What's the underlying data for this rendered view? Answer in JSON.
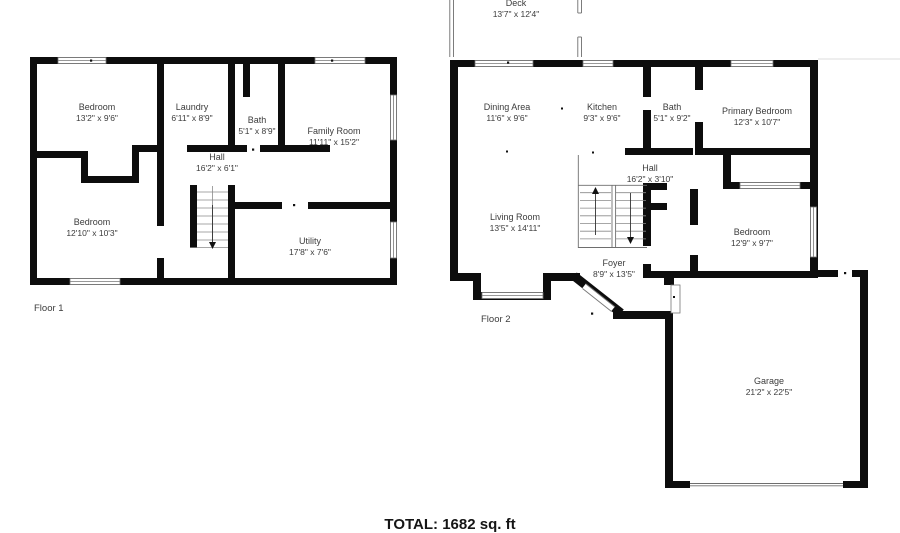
{
  "document": {
    "total": "TOTAL: 1682 sq. ft"
  },
  "floors": [
    {
      "label": "Floor 1",
      "rooms": [
        {
          "name": "Bedroom",
          "dims": "13'2\" x 9'6\""
        },
        {
          "name": "Laundry",
          "dims": "6'11\" x 8'9\""
        },
        {
          "name": "Bath",
          "dims": "5'1\" x 8'9\""
        },
        {
          "name": "Family Room",
          "dims": "11'11\" x 15'2\""
        },
        {
          "name": "Hall",
          "dims": "16'2\" x 6'1\""
        },
        {
          "name": "Bedroom",
          "dims": "12'10\" x 10'3\""
        },
        {
          "name": "Utility",
          "dims": "17'8\" x 7'6\""
        }
      ]
    },
    {
      "label": "Floor 2",
      "rooms": [
        {
          "name": "Deck",
          "dims": "13'7\" x 12'4\""
        },
        {
          "name": "Dining Area",
          "dims": "11'6\" x 9'6\""
        },
        {
          "name": "Kitchen",
          "dims": "9'3\" x 9'6\""
        },
        {
          "name": "Bath",
          "dims": "5'1\" x 9'2\""
        },
        {
          "name": "Primary Bedroom",
          "dims": "12'3\" x 10'7\""
        },
        {
          "name": "Hall",
          "dims": "16'2\" x 3'10\""
        },
        {
          "name": "Living Room",
          "dims": "13'5\" x 14'11\""
        },
        {
          "name": "Foyer",
          "dims": "8'9\" x 13'5\""
        },
        {
          "name": "Bedroom",
          "dims": "12'9\" x 9'7\""
        },
        {
          "name": "Garage",
          "dims": "21'2\" x 22'5\""
        }
      ]
    }
  ]
}
